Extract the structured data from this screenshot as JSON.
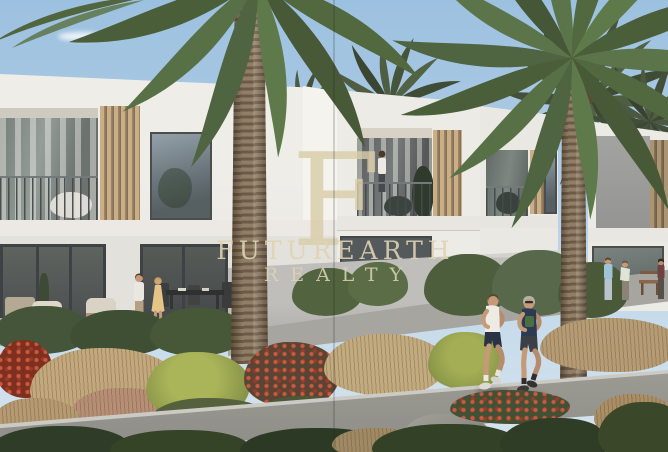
{
  "page": {
    "type": "real-estate-photo",
    "description": "Architectural rendering of a row of modern white two-storey townhouses with recessed balconies, wood-slat screens, date palms, landscaped beds and a jogging path, overlaid with a realty watermark"
  },
  "watermark": {
    "monogram": "F",
    "line1": "FUTUREARTH",
    "line2": "REALTY",
    "color": "#d8cca8"
  },
  "scene": {
    "sky": "clear light blue with small white clouds",
    "people": [
      "couple talking on ground-floor patio",
      "person standing on first-floor balcony",
      "two men jogging on the path",
      "group of residents near a bench at right"
    ],
    "vegetation": [
      "date palms",
      "clipped hedges",
      "tan ornamental grasses",
      "red flowering shrubs",
      "yellow-green shrubs"
    ],
    "palette": {
      "sky": "#a5c8e3",
      "building_white": "#eeece7",
      "building_shadow": "#b9b8b4",
      "wood_slat": "#c7ad85",
      "glass": "#65706c",
      "palm_green": "#57704a",
      "palm_trunk": "#8a775e",
      "hedge": "#4a5a39",
      "grass_tan": "#c0a87e",
      "flower_red": "#b5452f",
      "path_gray": "#98978f",
      "watermark": "#d8cca8"
    }
  }
}
